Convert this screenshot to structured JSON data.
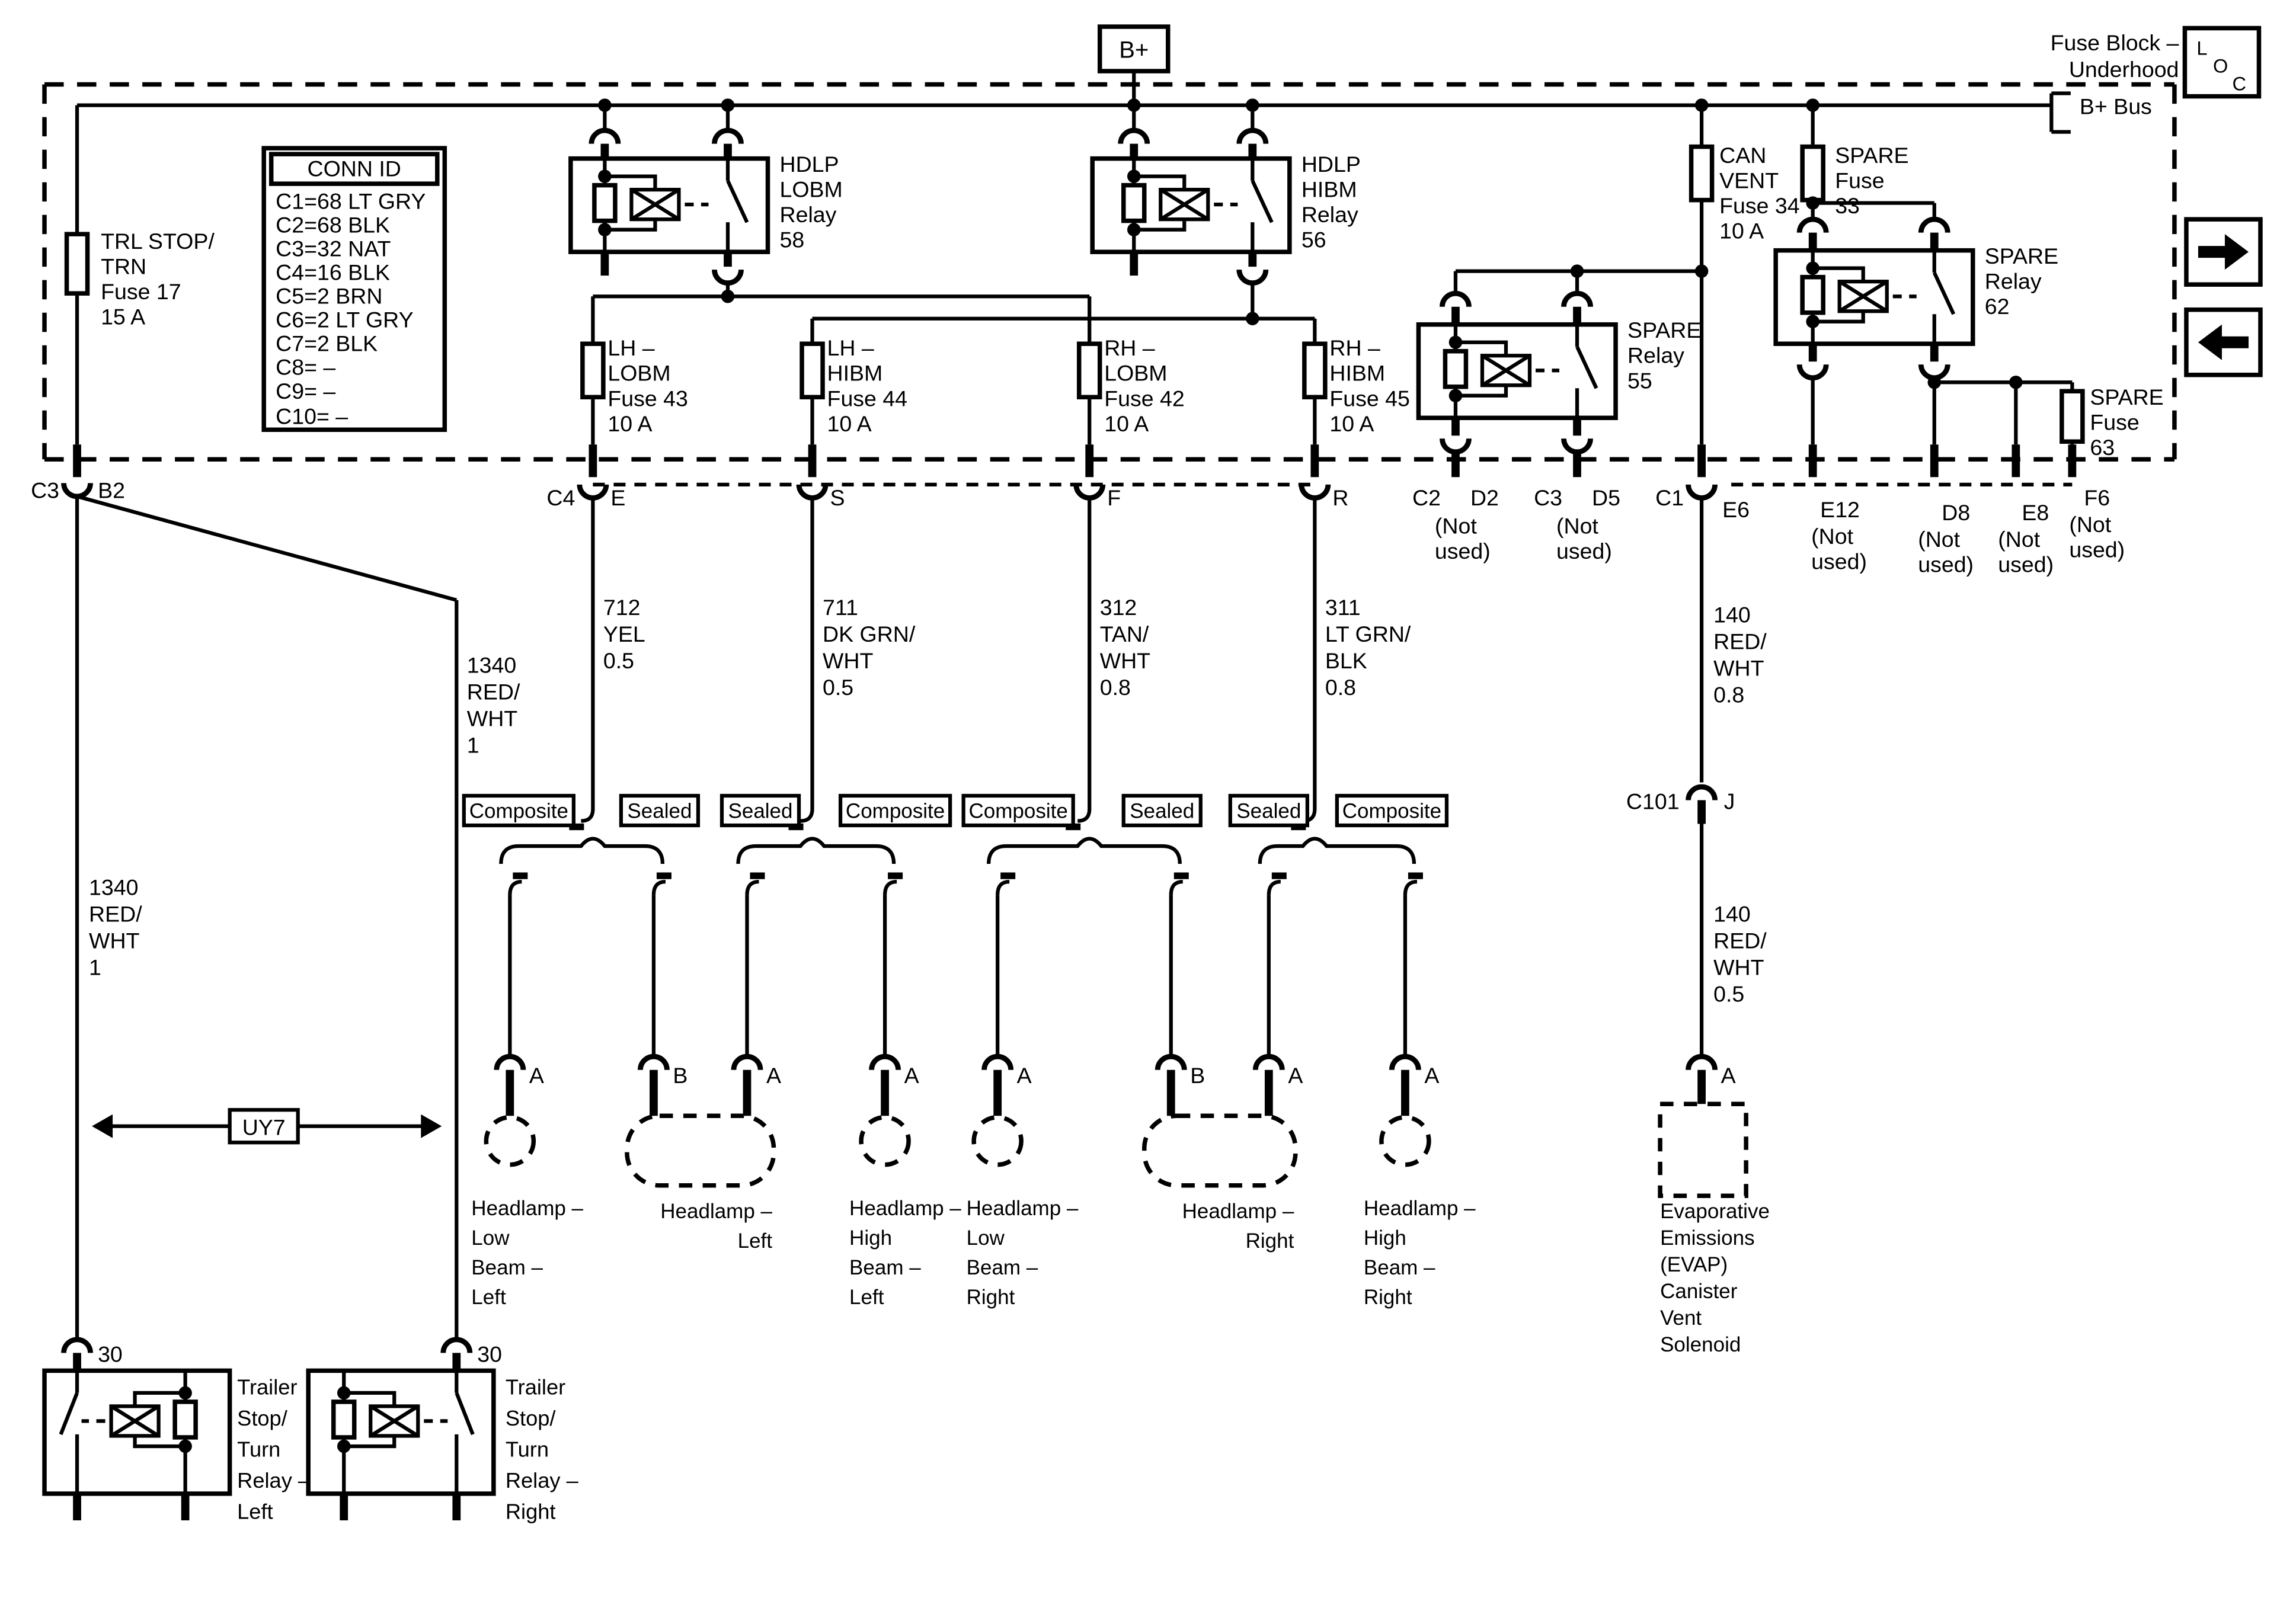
{
  "diagram": {
    "header": {
      "fuse_block": [
        "Fuse Block –",
        "Underhood"
      ],
      "loc": [
        "L",
        "O",
        "C"
      ],
      "bplus": "B+",
      "bplus_bus": "B+ Bus"
    },
    "conn_id": {
      "header": "CONN ID",
      "rows": [
        "C1=68 LT GRY",
        "C2=68 BLK",
        "C3=32 NAT",
        "C4=16 BLK",
        "C5=2 BRN",
        "C6=2 LT GRY",
        "C7=2 BLK",
        "C8= –",
        "C9= –",
        "C10= –"
      ]
    },
    "fuses": {
      "trl_stop": [
        "TRL STOP/",
        "TRN",
        "Fuse 17",
        "15 A"
      ],
      "can_vent": [
        "CAN",
        "VENT",
        "Fuse 34",
        "10 A"
      ],
      "spare33": [
        "SPARE",
        "Fuse",
        "33"
      ],
      "spare63": [
        "SPARE",
        "Fuse",
        "63"
      ],
      "lh_lobm": [
        "LH –",
        "LOBM",
        "Fuse 43",
        "10 A"
      ],
      "lh_hibm": [
        "LH –",
        "HIBM",
        "Fuse 44",
        "10 A"
      ],
      "rh_lobm": [
        "RH –",
        "LOBM",
        "Fuse 42",
        "10 A"
      ],
      "rh_hibm": [
        "RH –",
        "HIBM",
        "Fuse 45",
        "10 A"
      ]
    },
    "relays": {
      "hdlp_lobm": [
        "HDLP",
        "LOBM",
        "Relay",
        "58"
      ],
      "hdlp_hibm": [
        "HDLP",
        "HIBM",
        "Relay",
        "56"
      ],
      "spare55": [
        "SPARE",
        "Relay",
        "55"
      ],
      "spare62": [
        "SPARE",
        "Relay",
        "62"
      ],
      "trailer_left": [
        "Trailer",
        "Stop/",
        "Turn",
        "Relay –",
        "Left"
      ],
      "trailer_right": [
        "Trailer",
        "Stop/",
        "Turn",
        "Relay –",
        "Right"
      ]
    },
    "terminals": {
      "c3": "C3",
      "b2": "B2",
      "c4": "C4",
      "e": "E",
      "s": "S",
      "f": "F",
      "r": "R",
      "c2": "C2",
      "d2": "D2",
      "c3b": "C3",
      "d5": "D5",
      "c1": "C1",
      "e6": "E6",
      "e12": "E12",
      "d8": "D8",
      "e8": "E8",
      "f6": "F6",
      "c101": "C101",
      "j": "J",
      "a": "A",
      "b": "B",
      "t30": "30",
      "not_used": [
        "(Not",
        "used)"
      ]
    },
    "wires": {
      "w712": [
        "712",
        "YEL",
        "0.5"
      ],
      "w711": [
        "711",
        "DK GRN/",
        "WHT",
        "0.5"
      ],
      "w312": [
        "312",
        "TAN/",
        "WHT",
        "0.8"
      ],
      "w311": [
        "311",
        "LT GRN/",
        "BLK",
        "0.8"
      ],
      "w140a": [
        "140",
        "RED/",
        "WHT",
        "0.8"
      ],
      "w140b": [
        "140",
        "RED/",
        "WHT",
        "0.5"
      ],
      "w1340": [
        "1340",
        "RED/",
        "WHT",
        "1"
      ]
    },
    "splices": {
      "composite": "Composite",
      "sealed": "Sealed"
    },
    "lamps": {
      "low_left": [
        "Headlamp –",
        "Low",
        "Beam –",
        "Left"
      ],
      "left": [
        "Headlamp –",
        "Left"
      ],
      "high_left": [
        "Headlamp –",
        "High",
        "Beam –",
        "Left"
      ],
      "low_right": [
        "Headlamp –",
        "Low",
        "Beam –",
        "Right"
      ],
      "right": [
        "Headlamp –",
        "Right"
      ],
      "high_right": [
        "Headlamp –",
        "High",
        "Beam –",
        "Right"
      ]
    },
    "evap": [
      "Evaporative",
      "Emissions",
      "(EVAP)",
      "Canister",
      "Vent",
      "Solenoid"
    ],
    "option": "UY7"
  }
}
